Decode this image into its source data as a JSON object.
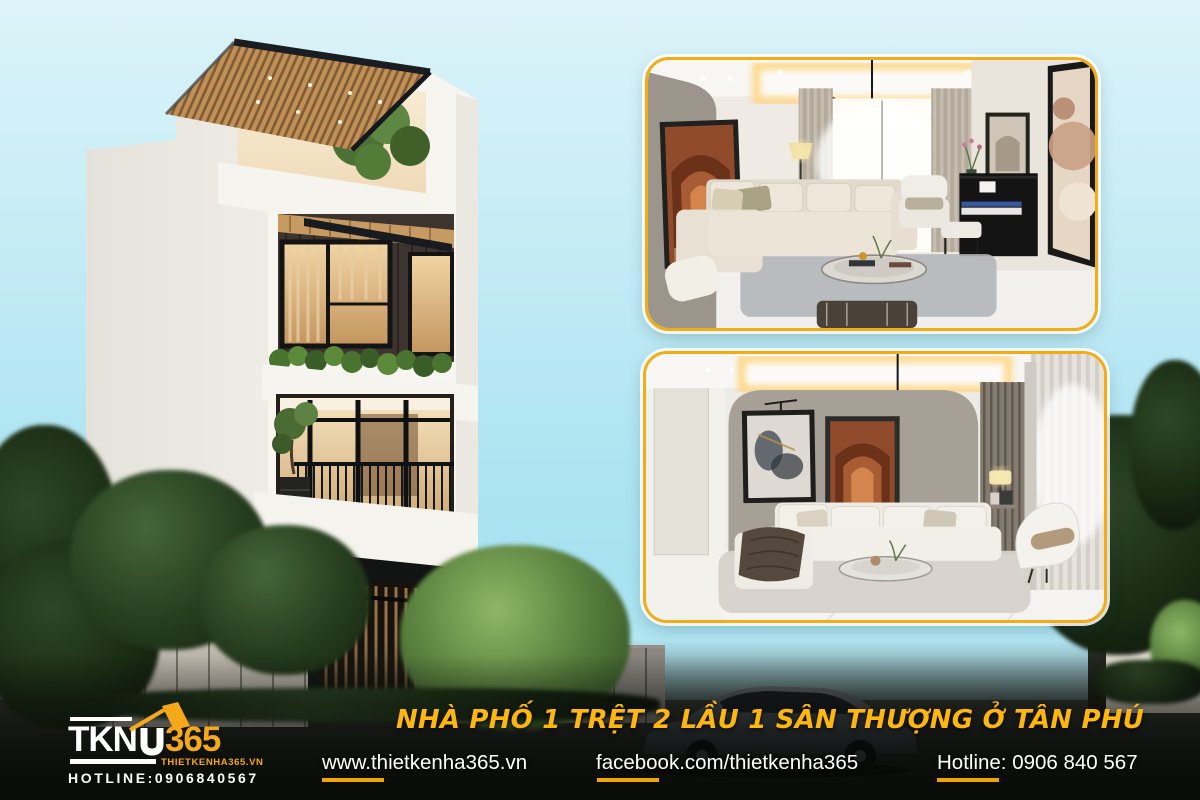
{
  "brand": {
    "logo_prefix": "TKN",
    "logo_suffix": "365",
    "logo_site": "THIETKENHA365.VN",
    "logo_hotline": "HOTLINE:0906840567"
  },
  "banner": {
    "title": "NHÀ PHỐ 1 TRỆT 2 LẦU 1 SÂN THƯỢNG Ở TÂN PHÚ",
    "links": [
      {
        "label": "www.thietkenha365.vn"
      },
      {
        "label": "facebook.com/thietkenha365"
      },
      {
        "label": "Hotline: 0906 840 567"
      }
    ]
  },
  "house": {
    "address_sign_number": "07",
    "address_sign_street": "TÔ HIỆU"
  },
  "panels": [
    {
      "name": "living-room-render-with-piano"
    },
    {
      "name": "living-room-render-arch-wall"
    }
  ],
  "colors": {
    "accent_yellow": "#F5A81B",
    "title_yellow": "#FFB70F",
    "underline_yellow": "#F2A50A",
    "panel_border": "#F3AC14",
    "sky_top": "#DCF3F9",
    "sky_bottom": "#A7E2F1",
    "dark_band": "#14160F"
  }
}
